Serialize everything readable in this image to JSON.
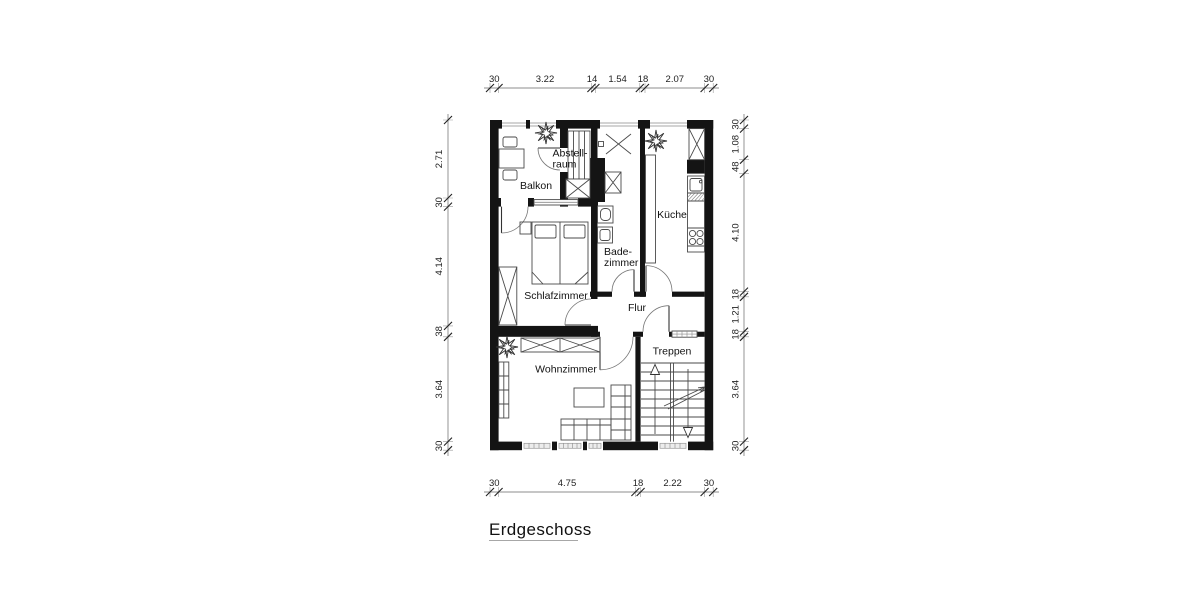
{
  "title": "Erdgeschoss",
  "rooms": {
    "balkon": "Balkon",
    "abstellraum": [
      "Abstell-",
      "raum"
    ],
    "schlafzimmer": "Schlafzimmer",
    "badezimmer": [
      "Bade-",
      "zimmer"
    ],
    "kueche": "Küche",
    "flur": "Flur",
    "wohnzimmer": "Wohnzimmer",
    "treppen": "Treppen"
  },
  "dimensions": {
    "top": [
      "30",
      "3.22",
      "14",
      "1.54",
      "18",
      "2.07",
      "30"
    ],
    "bottom": [
      "30",
      "4.75",
      "18",
      "2.22",
      "30"
    ],
    "left": [
      "2.71",
      "30",
      "4.14",
      "38",
      "3.64",
      "30"
    ],
    "right": [
      "30",
      "1.08",
      "48",
      "4.10",
      "18",
      "1.21",
      "18",
      "3.64",
      "30"
    ]
  },
  "colors": {
    "wall": "#141414",
    "furniture": "#4a4a4a",
    "dimension": "#222222",
    "background": "#ffffff"
  }
}
